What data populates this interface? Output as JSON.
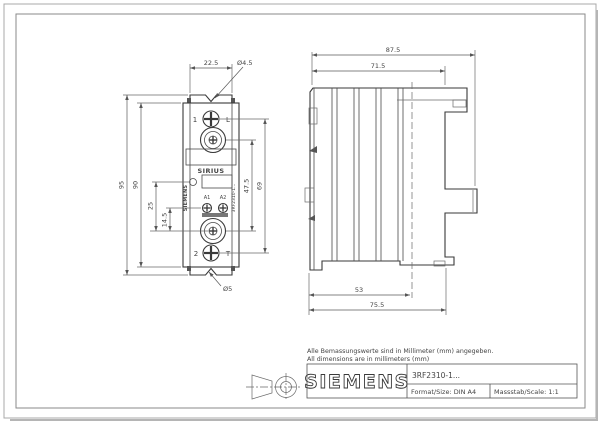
{
  "page": {
    "notes": {
      "line1": "Alle Bemassungswerte sind in Millimeter (mm) angegeben.",
      "line2": "All dimensions are in millimeters (mm)"
    },
    "title_block": {
      "brand": "SIEMENS",
      "model": "3RF2310-1...",
      "format_label": "Format/Size: DIN A4",
      "scale_label": "Massstab/Scale: 1:1"
    }
  },
  "front_view": {
    "dims": {
      "tab_width": "22.5",
      "mount_hole_top": "Ø4.5",
      "mount_hole_bottom": "Ø5",
      "height_overall": "95",
      "height_body": "90",
      "led_to_terminal": "25",
      "ctrl_screw_to_terminal": "14.5",
      "terminal_centers": "47.5",
      "screw_centers": "69"
    },
    "labels": {
      "terminal_top_num": "1",
      "terminal_top_letter": "L",
      "terminal_bottom_num": "2",
      "terminal_bottom_letter": "T",
      "ctrl_a1": "A1",
      "ctrl_a2": "A2",
      "product_line": "SIRIUS",
      "brand_vertical": "SIEMENS",
      "model_vertical": "3RF2310-1..."
    }
  },
  "side_view": {
    "dims": {
      "depth_overall": "87.5",
      "depth_body": "71.5",
      "depth_to_din_center": "53",
      "depth_to_front": "75.5"
    }
  }
}
